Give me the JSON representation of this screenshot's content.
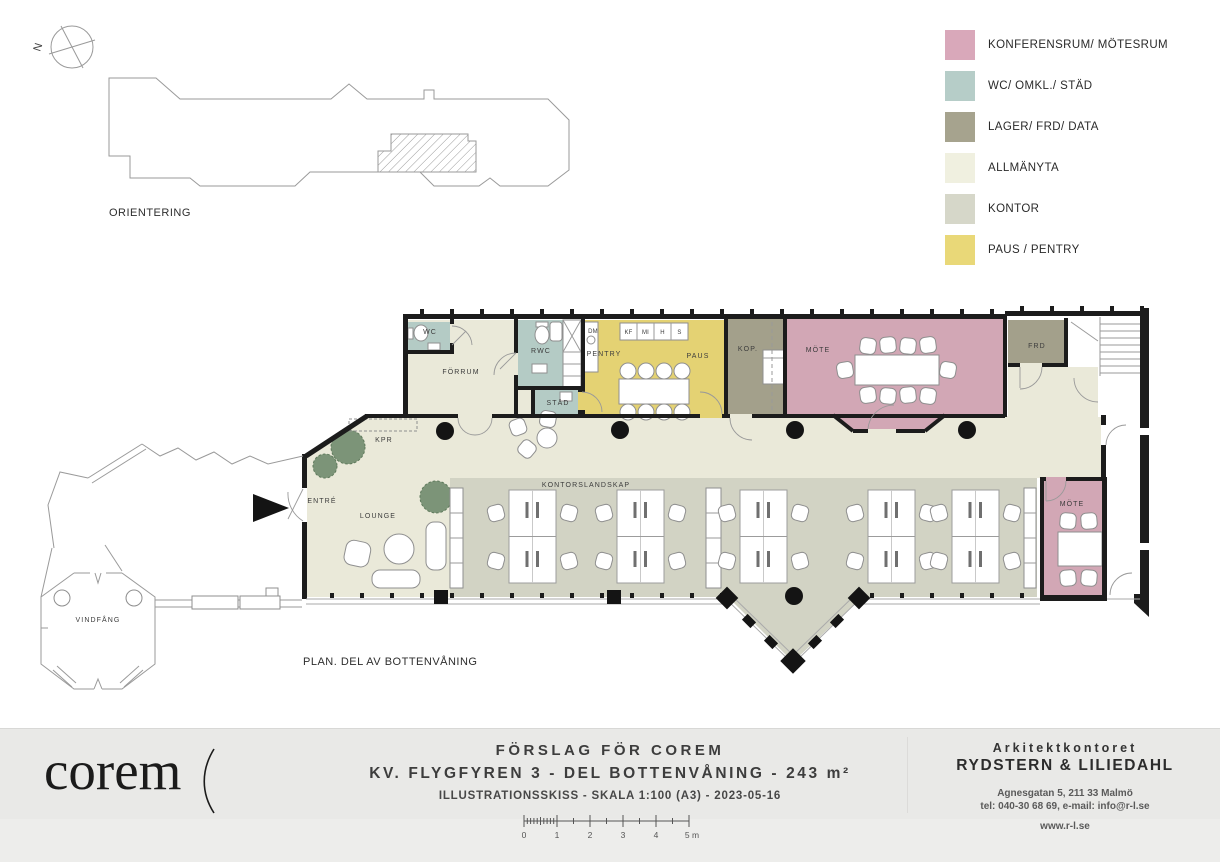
{
  "orientation": {
    "label": "ORIENTERING",
    "compass": "N"
  },
  "legend": {
    "items": [
      {
        "label": "KONFERENSRUM/ MÖTESRUM",
        "color": "#d9a8ba"
      },
      {
        "label": "WC/ OMKL./ STÄD",
        "color": "#b6cdc8"
      },
      {
        "label": "LAGER/ FRD/ DATA",
        "color": "#a6a38e"
      },
      {
        "label": "ALLMÄNYTA",
        "color": "#f0f0e0"
      },
      {
        "label": "KONTOR",
        "color": "#d6d7c9"
      },
      {
        "label": "PAUS / PENTRY",
        "color": "#e9d878"
      }
    ]
  },
  "plan": {
    "caption": "PLAN. DEL AV BOTTENVÅNING",
    "labels": {
      "wc": "WC",
      "forrum": "FÖRRUM",
      "rwc": "RWC",
      "stad": "STÄD",
      "dm": "DM",
      "kf": "KF",
      "mi": "MI",
      "h": "H",
      "s": "S",
      "pentry": "PENTRY",
      "paus": "PAUS",
      "kop": "KOP.",
      "mote": "MÖTE",
      "frd": "FRD",
      "kpr": "KPR",
      "entre": "ENTRÉ",
      "lounge": "LOUNGE",
      "kontorslandskap": "KONTORSLANDSKAP",
      "mote_small": "MÖTE",
      "vindfang": "VINDFÅNG"
    }
  },
  "footer": {
    "logo": "corem",
    "title1": "FÖRSLAG FÖR COREM",
    "title2": "KV. FLYGFYREN 3 - DEL BOTTENVÅNING - 243 m²",
    "title3": "ILLUSTRATIONSSKISS - SKALA 1:100 (A3) - 2023-05-16",
    "scalebar": {
      "labels": [
        "0",
        "1",
        "2",
        "3",
        "4",
        "5 m"
      ]
    },
    "architect": {
      "line1": "Arkitektkontoret",
      "line2": "RYDSTERN & LILIEDAHL",
      "line3": "Agnesgatan 5, 211 33 Malmö",
      "line4": "tel: 040-30 68 69, e-mail: info@r-l.se",
      "line5": "www.r-l.se"
    }
  }
}
